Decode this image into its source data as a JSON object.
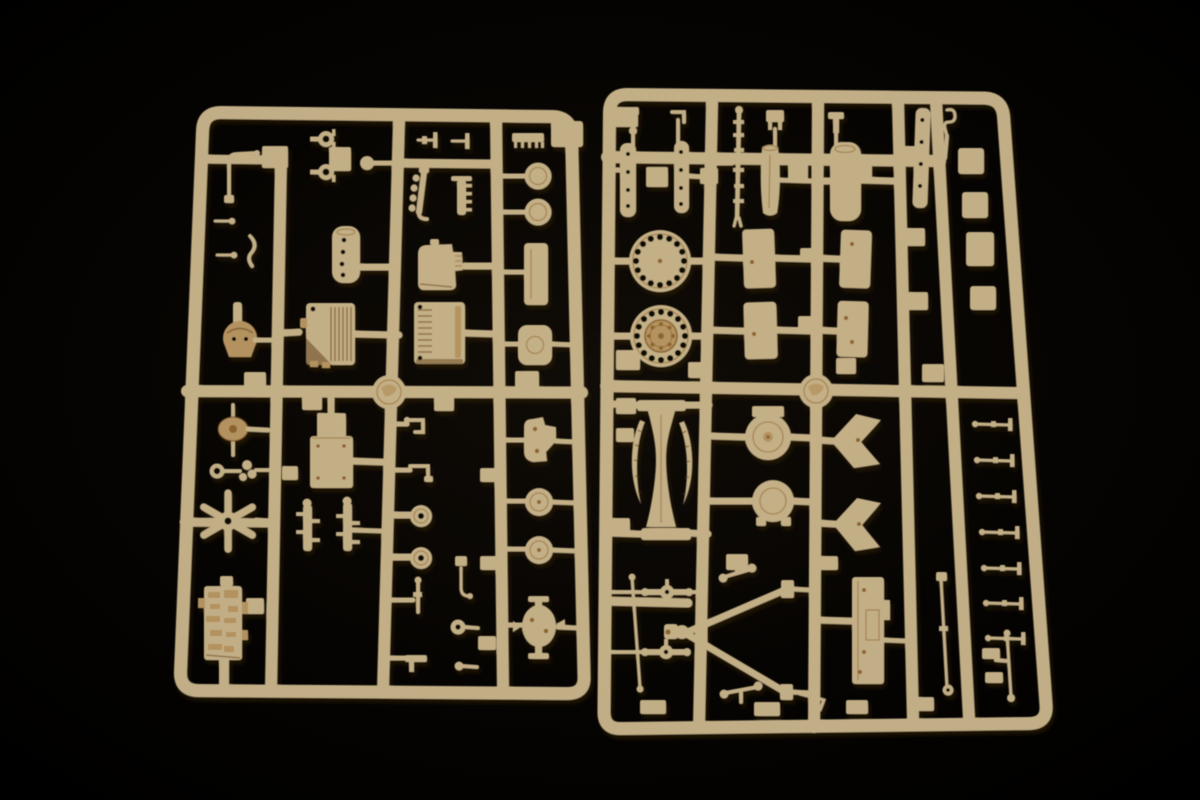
{
  "meta": {
    "type": "photograph",
    "subject": "Two tan injection-molded plastic model kit sprues (part trees) laid side by side on a black background",
    "items_count": "2"
  },
  "colors": {
    "background": "#000000",
    "glow": "#120d07",
    "plastic": "#ecd4a3",
    "plastic_light": "#f7e9ca",
    "plastic_shade": "#d9b173",
    "plastic_dark": "#a97735",
    "plastic_deep": "#6f4418",
    "hole": "#0b0703"
  },
  "left_sprue": {
    "label": "Sprue A - engine blocks, hull fittings, fan wheel and small parts",
    "parts": [
      "bent grab handle",
      "ring pins",
      "tow hook",
      "ball fitting",
      "T-pins",
      "comb grille",
      "exhaust manifold",
      "ribbed muffler",
      "idler discs",
      "perforated cylinder",
      "gearbox cover",
      "engine block left",
      "engine block right",
      "long plate",
      "canteen hatch",
      "turret dome",
      "cooling fan disc",
      "ring donut",
      "rotor cluster",
      "six-spoke wheel",
      "gun shield box",
      "lever brackets",
      "small road wheels",
      "vertical pin",
      "L-hook",
      "small wheel",
      "hull receiver",
      "winged bracket",
      "drum caps",
      "cross bracket",
      "molding stamp"
    ]
  },
  "right_sprue": {
    "label": "Sprue B - perforated road wheels, fender panels, hatches, A-frame trail and axles",
    "parts": [
      "faucet fitting",
      "L-fitting",
      "clamp",
      "bracket",
      "tow hook",
      "drilled stick A",
      "drilled stick B",
      "recoil cylinder rod",
      "waisted barrel half",
      "large cylinder",
      "drilled strip",
      "perforated road wheel",
      "perforated road wheel with hub",
      "fender panel x4",
      "round hatch with tab",
      "round hatch with feet",
      "chevron bracket x2",
      "leaf springs",
      "hourglass mount",
      "cross links",
      "long tie rod",
      "A-frame trail",
      "trail box",
      "axle rods",
      "pin fittings x7",
      "equipment blocks",
      "molding stamp"
    ]
  }
}
